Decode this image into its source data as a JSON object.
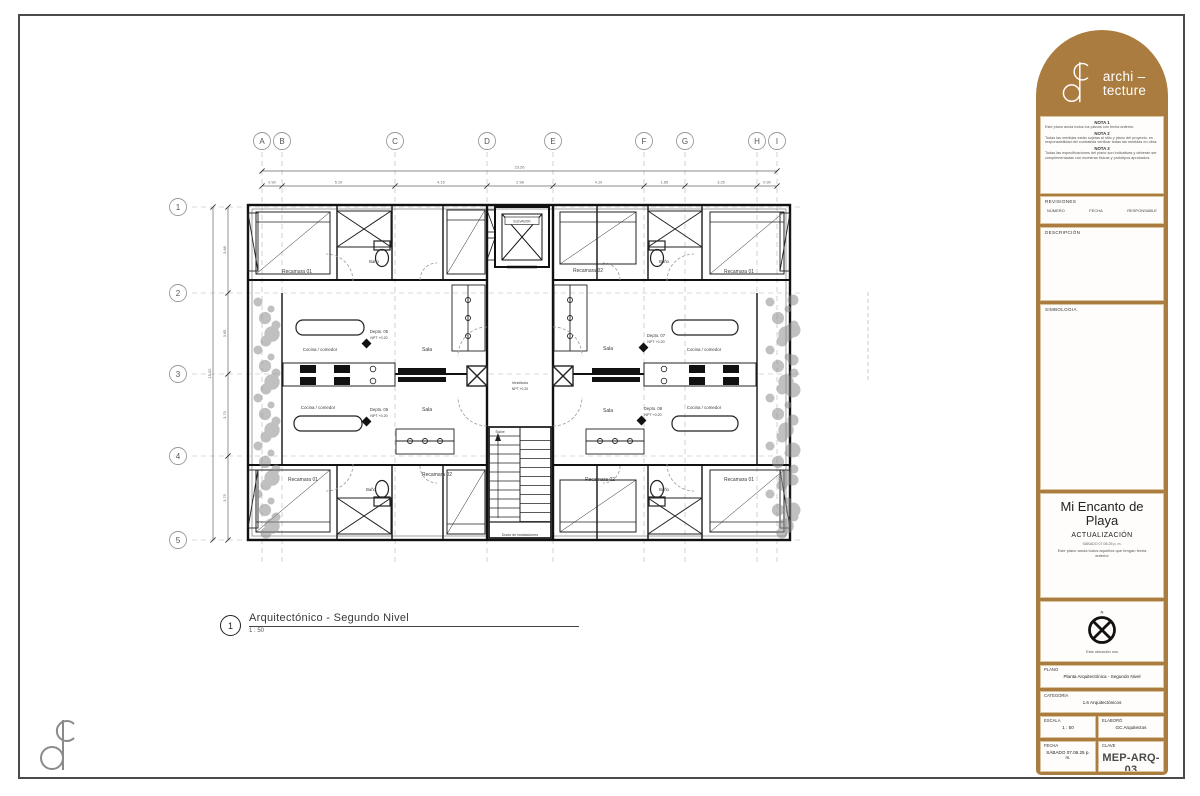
{
  "colors": {
    "brand_brown": "#ab7c3f",
    "line": "#1a1a1a",
    "grid": "#b5b5b5",
    "veg": "#8d8d8d"
  },
  "plan": {
    "caption": {
      "number": "1",
      "title": "Arquitectónico - Segundo Nivel",
      "scale": "1 : 50"
    },
    "grid_cols": [
      {
        "l": "A",
        "x": 262
      },
      {
        "l": "B",
        "x": 282
      },
      {
        "l": "C",
        "x": 395
      },
      {
        "l": "D",
        "x": 487
      },
      {
        "l": "E",
        "x": 553
      },
      {
        "l": "F",
        "x": 644
      },
      {
        "l": "G",
        "x": 685
      },
      {
        "l": "H",
        "x": 757
      },
      {
        "l": "I",
        "x": 777
      }
    ],
    "grid_rows": [
      {
        "l": "1",
        "y": 207
      },
      {
        "l": "2",
        "y": 293
      },
      {
        "l": "3",
        "y": 374
      },
      {
        "l": "4",
        "y": 456
      },
      {
        "l": "5",
        "y": 540
      }
    ],
    "dims": {
      "top_total": "23.26",
      "top_segments": [
        "0.90",
        "5.10",
        "4.15",
        "2.98",
        "4.10",
        "1.85",
        "3.25",
        "0.90"
      ],
      "left_total": "15.02",
      "left_segments": [
        "3.88",
        "3.65",
        "3.70",
        "3.79"
      ]
    },
    "labels": [
      {
        "t": "Recamara 01",
        "x": 297,
        "y": 273,
        "s": 5
      },
      {
        "t": "Baño",
        "x": 374,
        "y": 263,
        "s": 4.2
      },
      {
        "t": "Recamara 02",
        "x": 588,
        "y": 272,
        "s": 5
      },
      {
        "t": "Baño",
        "x": 664,
        "y": 263,
        "s": 4.2
      },
      {
        "t": "Recamara 01",
        "x": 739,
        "y": 273,
        "s": 5
      },
      {
        "t": "Recamara 01",
        "x": 303,
        "y": 481,
        "s": 5
      },
      {
        "t": "Baño",
        "x": 371,
        "y": 491,
        "s": 4.2
      },
      {
        "t": "Recamara 02",
        "x": 437,
        "y": 476,
        "s": 5
      },
      {
        "t": "Recamara 02",
        "x": 600,
        "y": 481,
        "s": 5
      },
      {
        "t": "Baño",
        "x": 664,
        "y": 491,
        "s": 4.2
      },
      {
        "t": "Recamara 01",
        "x": 739,
        "y": 481,
        "s": 5
      },
      {
        "t": "Sala",
        "x": 427,
        "y": 351,
        "s": 5
      },
      {
        "t": "Sala",
        "x": 427,
        "y": 411,
        "s": 5
      },
      {
        "t": "Sala",
        "x": 608,
        "y": 350,
        "s": 5
      },
      {
        "t": "Sala",
        "x": 608,
        "y": 412,
        "s": 5
      },
      {
        "t": "Cocina / comedor",
        "x": 320,
        "y": 351,
        "s": 4.4
      },
      {
        "t": "Cocina / comedor",
        "x": 318,
        "y": 409,
        "s": 4.4
      },
      {
        "t": "Cocina / comedor",
        "x": 704,
        "y": 351,
        "s": 4.4
      },
      {
        "t": "Cocina / comedor",
        "x": 704,
        "y": 409,
        "s": 4.4
      },
      {
        "t": "Depto. 05",
        "x": 379,
        "y": 333,
        "s": 4.2
      },
      {
        "t": "NPT +0.20",
        "x": 379,
        "y": 339,
        "s": 3.6
      },
      {
        "t": "Depto. 06",
        "x": 379,
        "y": 411,
        "s": 4.2
      },
      {
        "t": "NPT +0.20",
        "x": 379,
        "y": 417,
        "s": 3.6
      },
      {
        "t": "Depto. 07",
        "x": 656,
        "y": 337,
        "s": 4.2
      },
      {
        "t": "NPT +0.20",
        "x": 656,
        "y": 343,
        "s": 3.6
      },
      {
        "t": "Depto. 08",
        "x": 653,
        "y": 410,
        "s": 4.2
      },
      {
        "t": "NPT +0.20",
        "x": 653,
        "y": 416,
        "s": 3.6
      },
      {
        "t": "Vestíbulo",
        "x": 520,
        "y": 384,
        "s": 4
      },
      {
        "t": "NPT +0.20",
        "x": 520,
        "y": 390,
        "s": 3.4
      },
      {
        "t": "Sube",
        "x": 500,
        "y": 433,
        "s": 4
      },
      {
        "t": "ELEVADOR",
        "x": 522,
        "y": 222.5,
        "s": 3.2
      },
      {
        "t": "Ducto de instalaciones",
        "x": 520,
        "y": 536,
        "s": 3.6
      }
    ]
  },
  "titleblock": {
    "brand": {
      "line1": "archi –",
      "line2": "tecture"
    },
    "notes": [
      {
        "title": "NOTA 1",
        "body": "Este plano anula todos los planos con fecha anterior."
      },
      {
        "title": "NOTA 2",
        "body": "Todas las medidas están sujetas al sitio y plano del proyecto, es responsabilidad del contratista verificar todas las medidas en obra."
      },
      {
        "title": "NOTA 3",
        "body": "Todas las especificaciones del plano son indicativas y deberán ser complementadas con muestras físicas y prototipos aprobados."
      }
    ],
    "revisions": {
      "title": "REVISIONES",
      "col1": "NÚMERO",
      "col2": "FECHA",
      "col3": "RESPONSABLE"
    },
    "description_title": "DESCRIPCIÓN",
    "symbology_title": "SIMBOLOGIA",
    "project": {
      "name_line1": "Mi Encanto de",
      "name_line2": "Playa",
      "subtitle": "ACTUALIZACIÓN",
      "date": "SÁBADO 07.06.25 p. m.",
      "note": "Este plano anula todos  aquellos que tengan fecha anterior"
    },
    "north_caption": "Esta ubicación nos",
    "fields": {
      "plano_label": "PLANO",
      "plano_value": "Planta Arquitectónica - Segundo Nivel",
      "categoria_label": "CATEGORIA",
      "categoria_value": "1.6 Arquitectónicos",
      "escala_label": "ESCALA",
      "escala_value": "1 : 50",
      "elaboro_label": "ELABORÓ",
      "elaboro_value": "GC Arquitectos",
      "fecha_label": "FECHA",
      "fecha_value": "SÁBADO 07.06.25 p. m.",
      "clave_label": "CLAVE",
      "clave_value": "MEP-ARQ-03"
    }
  }
}
